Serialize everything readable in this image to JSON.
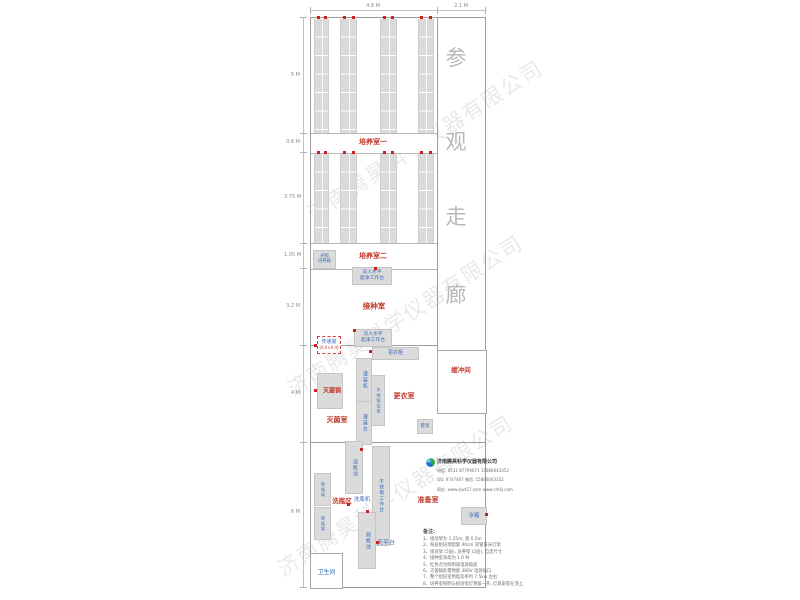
{
  "dimensions": {
    "top": [
      "4.8 M",
      "2.1 M"
    ],
    "left": [
      "5 M",
      "0.6 M",
      "3.75 M",
      "1.05 M",
      "3.2 M",
      "4 M",
      "6 M"
    ]
  },
  "corridor": {
    "chars": [
      "参",
      "观",
      "走",
      "廊"
    ]
  },
  "rooms": {
    "culture1": "培养室一",
    "culture2": "培养室二",
    "inoculation": "接种室",
    "sterilization": "灭菌室",
    "changing": "更衣室",
    "buffer": "缓冲间",
    "washing": "洗瓶区",
    "preparation": "准备室"
  },
  "equipment": {
    "light_incubator": "光照\n培养箱",
    "clean_bench": "双人水平\n超净工作台",
    "pass_window": "传递窗",
    "pass_window_size": "(0.4×0.4)",
    "wardrobe": "更衣柜",
    "filling_machine": "灌装机",
    "ss_shelf": "不锈钢货架",
    "sterilizer": "灭菌锅",
    "shoe_rack": "鞋架",
    "filling_table": "灌装台",
    "soak_pool": "泡瓶池",
    "ss_workbench": "不锈钢工作台",
    "bottle_washer": "洗瓶机",
    "drying_rack": "晾瓶架",
    "rinse_pool": "涮瓶池",
    "balance_table": "天平台",
    "fridge": "冰箱",
    "toilet": "卫生间"
  },
  "company": {
    "name": "济南腾昊科学仪器有限公司",
    "phone": "电话: 0531-87799671  15866643352",
    "qq": "QQ: 9747467  微信: 15866643352",
    "web": "网址: www.sjwt27.com  www.crhkj.com"
  },
  "notes": {
    "title": "备注:",
    "items": [
      "1、组培架为 1.25m, 宽 0.5m",
      "2、每层组培架配套 40cm 双管日光灯架",
      "3、组培架 (5层), 培养架 (2层), 自定尺寸",
      "4、接种室净高为 1.0 M",
      "5、红色点为照明或电源插座",
      "6、灭菌锅处需预留 380V 电源插口",
      "7、整个组培室用电功率约 7.5kw 左右",
      "8、培养室照明与组培架灯预留一齐, 灯具安装在顶上."
    ]
  },
  "watermark": "济南腾昊科学仪器有限公司"
}
